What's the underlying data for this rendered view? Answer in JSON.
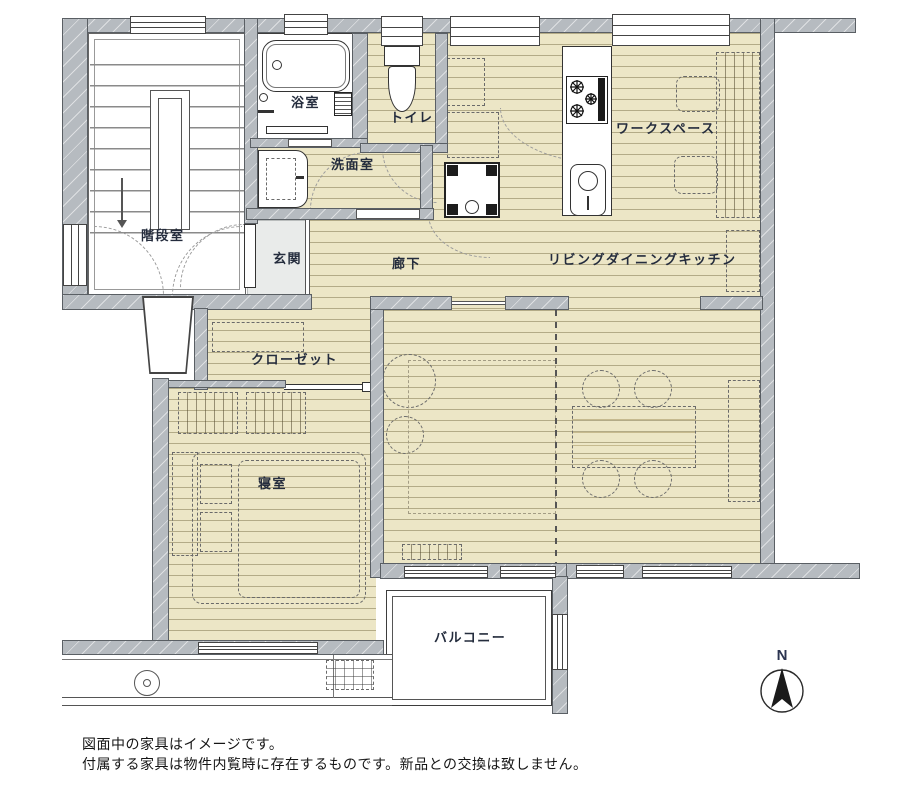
{
  "title": "floor-plan",
  "rooms": [
    {
      "id": "bathroom",
      "label": "浴室"
    },
    {
      "id": "toilet",
      "label": "トイレ"
    },
    {
      "id": "washroom",
      "label": "洗面室"
    },
    {
      "id": "stairwell",
      "label": "階段室"
    },
    {
      "id": "entrance",
      "label": "玄関"
    },
    {
      "id": "hallway",
      "label": "廊下"
    },
    {
      "id": "ldk",
      "label": "リビングダイニングキッチン"
    },
    {
      "id": "workspace",
      "label": "ワークスペース"
    },
    {
      "id": "closet",
      "label": "クローゼット"
    },
    {
      "id": "bedroom",
      "label": "寝室"
    },
    {
      "id": "balcony",
      "label": "バルコニー"
    }
  ],
  "compass": {
    "label": "N"
  },
  "notes": {
    "line1": "図面中の家具はイメージです。",
    "line2": "付属する家具は物件内覧時に存在するものです。新品との交換は致しません。"
  },
  "colors": {
    "floor_beige": "#ece6c6",
    "wall_gray": "#b6bbc0",
    "label_navy": "#242c3d"
  }
}
